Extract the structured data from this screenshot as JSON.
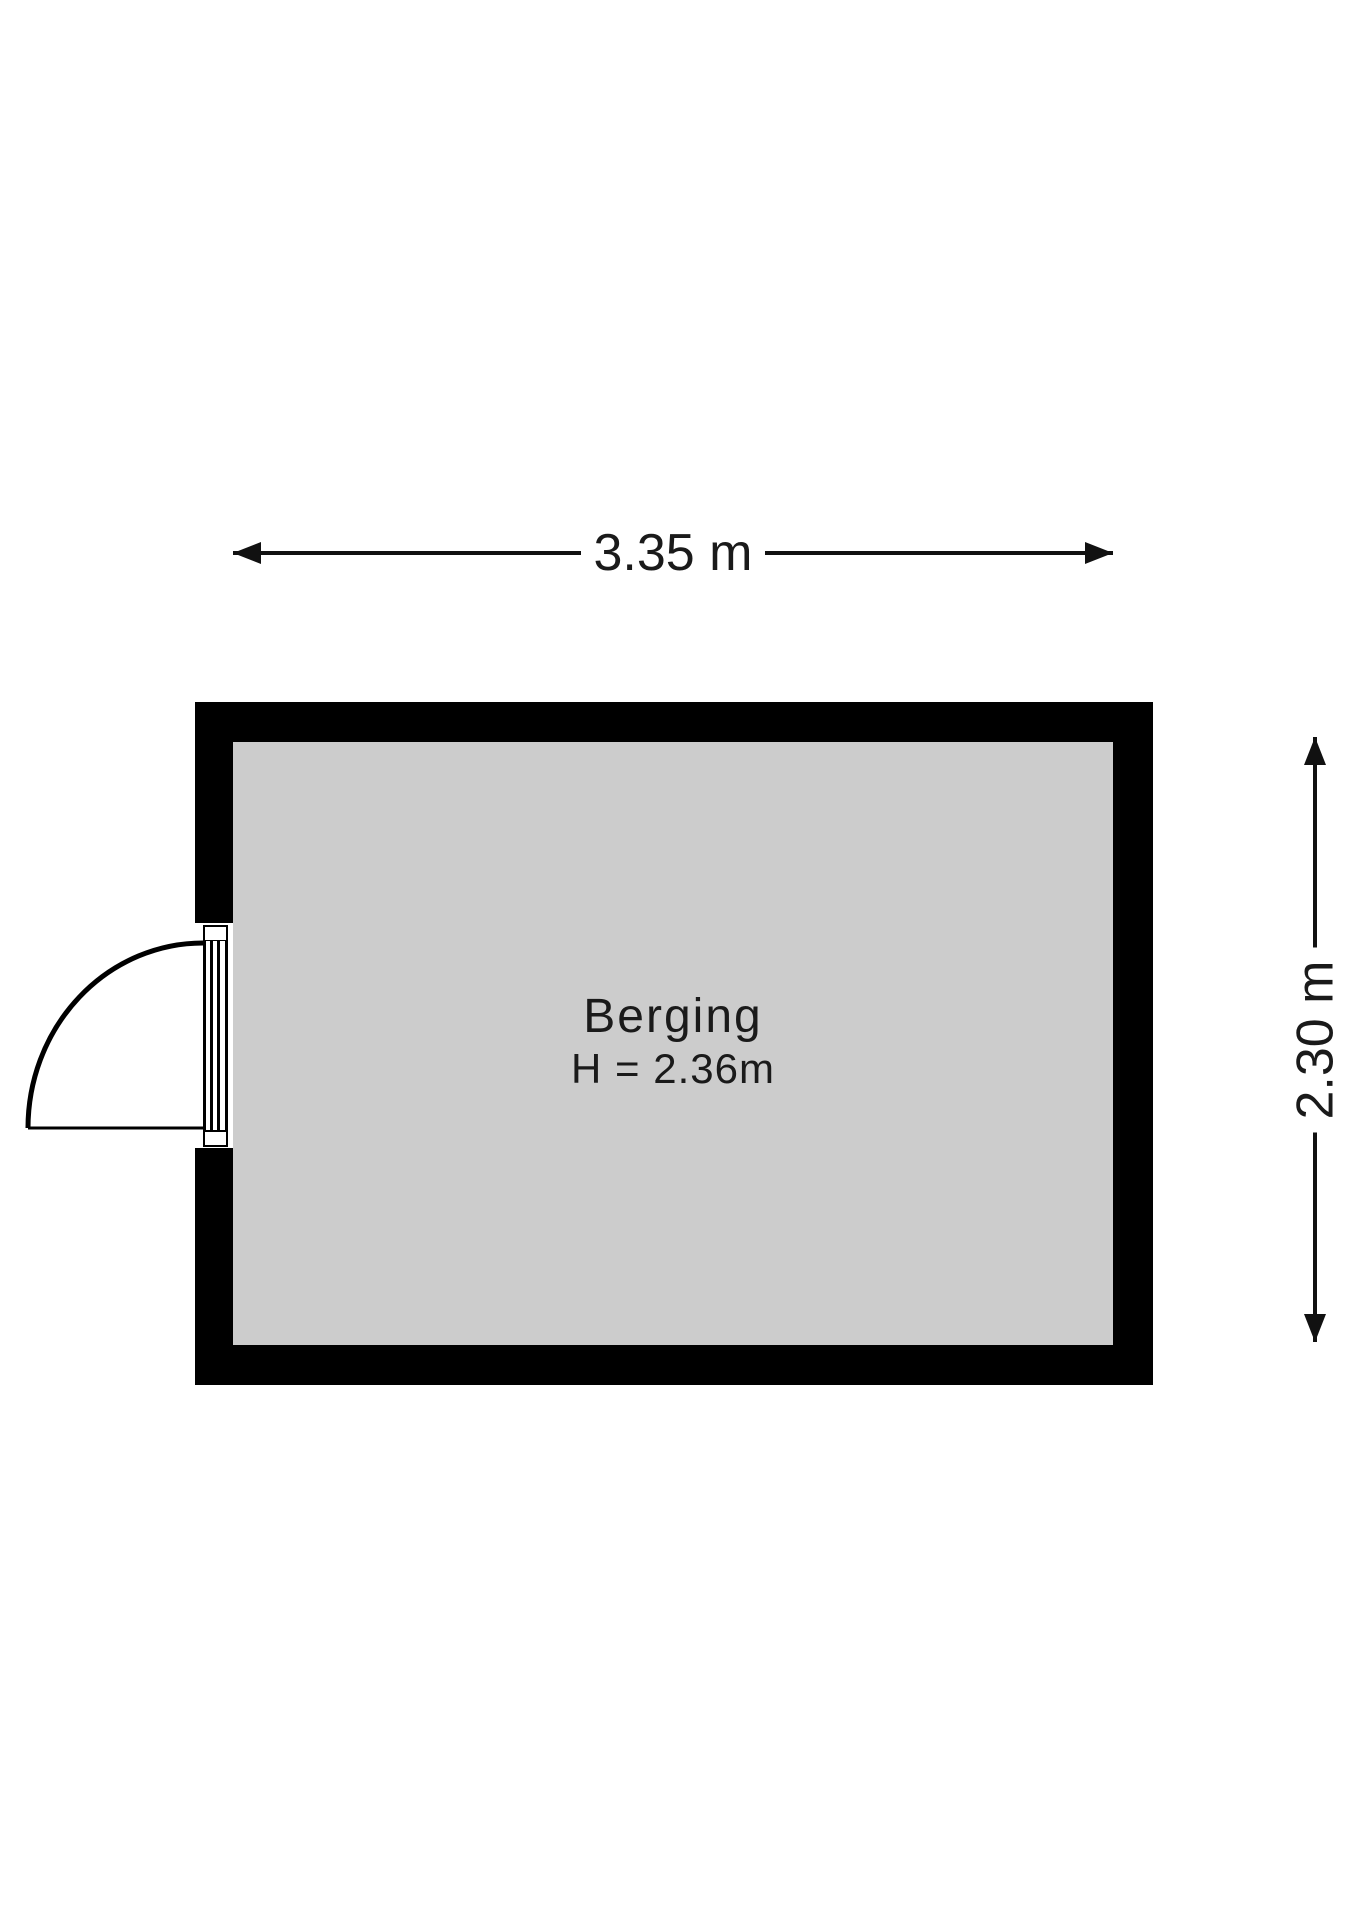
{
  "room": {
    "name": "Berging",
    "ceiling_height_label": "H = 2.36m"
  },
  "dimensions": {
    "width_label": "3.35 m",
    "height_label": "2.30 m"
  },
  "colors": {
    "wall": "#000000",
    "floor": "#cccccc",
    "background": "#ffffff",
    "line": "#111111",
    "text": "#1a1a1a"
  }
}
